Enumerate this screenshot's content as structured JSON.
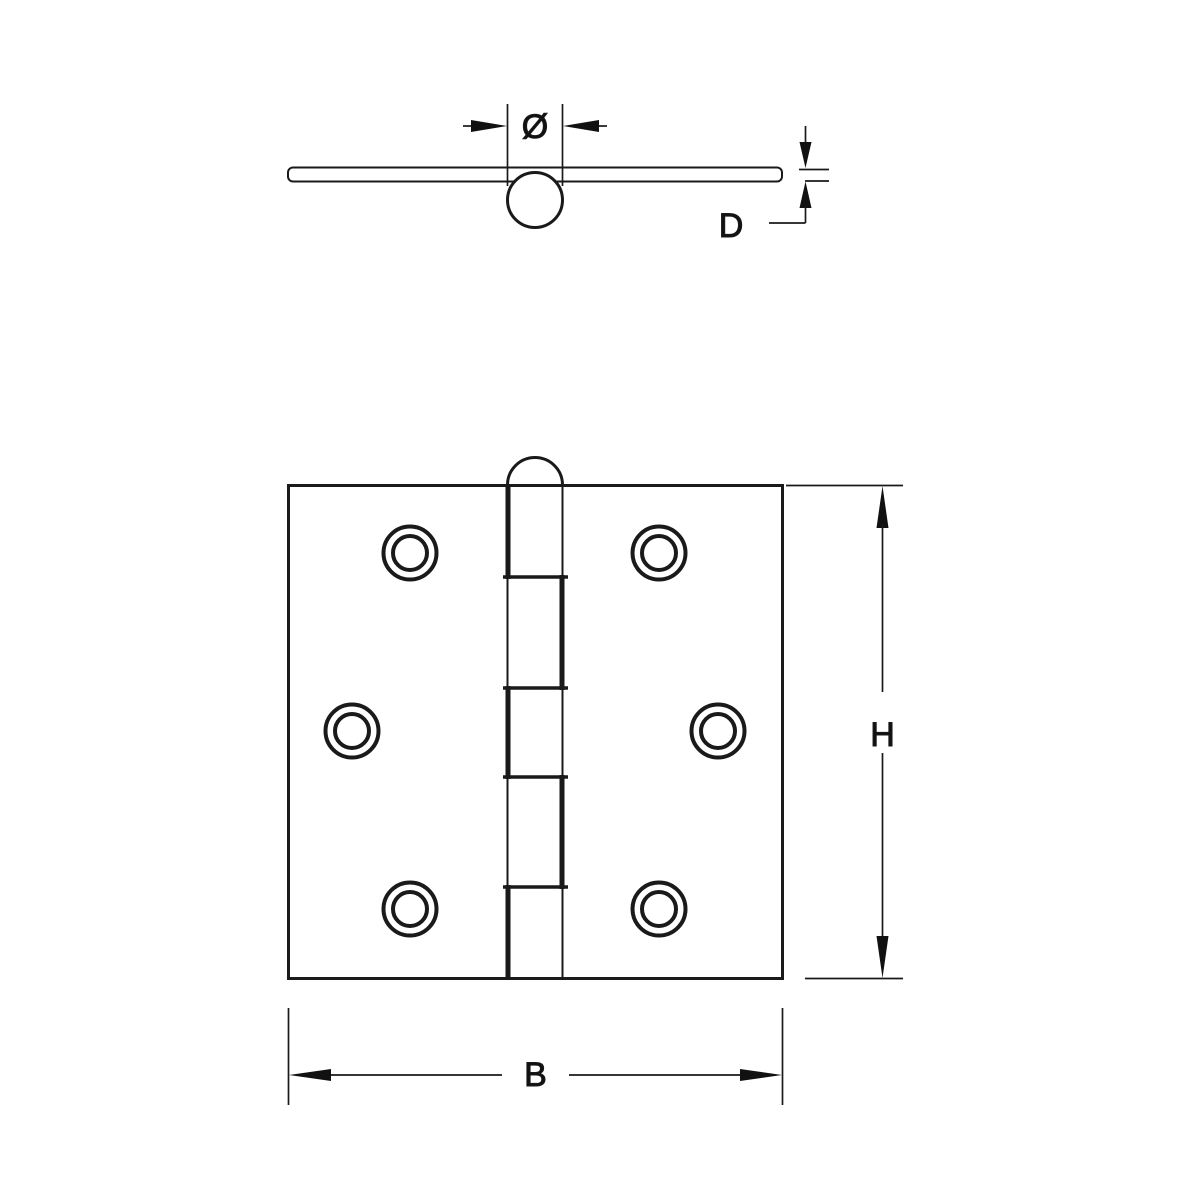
{
  "drawing": {
    "labels": {
      "pin_diameter": "Ø",
      "thickness": "D",
      "height": "H",
      "width": "B"
    },
    "colors": {
      "line": "#1a1a1a",
      "background": "#ffffff"
    }
  }
}
